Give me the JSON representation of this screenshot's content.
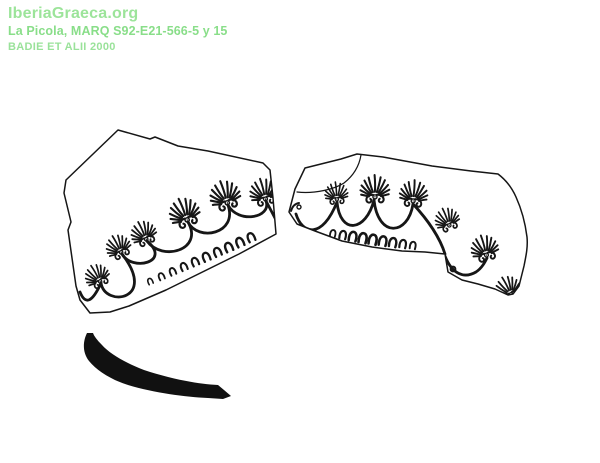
{
  "page": {
    "background_color": "#ffffff"
  },
  "watermark": {
    "site": "IberiaGraeca.org",
    "object_label": "La Picola, MARQ S92-E21-566-5 y 15",
    "reference": "BADIE ET ALII 2000",
    "site_color": "#9ce49a",
    "object_label_color": "#89de89",
    "reference_color": "#9ae29a"
  },
  "illustration": {
    "ink_color": "#161616",
    "left_sherd": {
      "palmette_count": 6,
      "festoon_arc_count": 7,
      "ovolo_count": 10
    },
    "right_sherd": {
      "palmette_count": 6,
      "festoon_arc_count": 4,
      "ovolo_count": 9,
      "has_crack_line": true
    },
    "rim_profile_stroke": {
      "fill_color": "#111111"
    }
  }
}
